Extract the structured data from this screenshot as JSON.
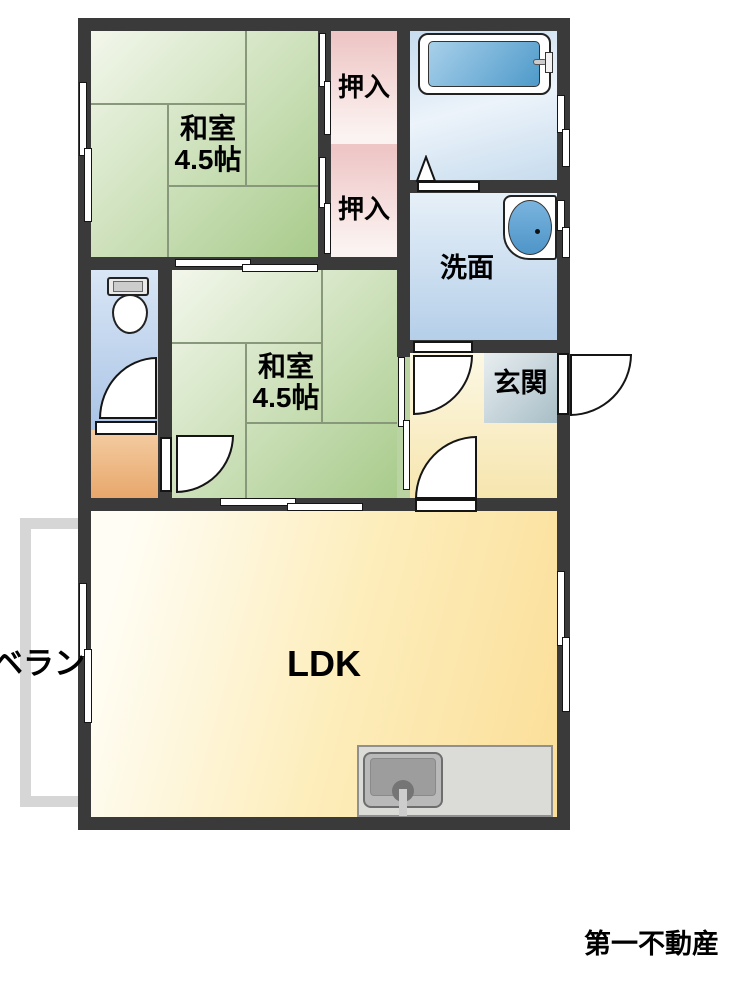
{
  "colors": {
    "wall": "#3a3a3a",
    "tatami-light": "#f3f7ec",
    "tatami-dark": "#a8cb8b",
    "tatami-line": "#87997a",
    "closet-pink": "#eec6c6",
    "closet-pink-pale": "#fbf3f1",
    "bath-blue": "#c7dcee",
    "bath-blue-pale": "#ecf3fa",
    "washroom-blue-top": "#e6f0f8",
    "washroom-blue-bottom": "#b5cfe9",
    "toilet-blue-top": "#d9e6f5",
    "toilet-blue-bottom": "#aac4e6",
    "hall-cream-top": "#fcf8e4",
    "hall-cream-bottom": "#f6e5ae",
    "tile-gray": "#a8bec7",
    "ldk-light": "#fffdf4",
    "ldk-deep": "#fbde98",
    "nook-top": "#f4cda2",
    "nook-bottom": "#e8a76c",
    "balcony": "#d6d6d6",
    "counter": "#dbdbd8",
    "tub-blue": "#4e9aca",
    "tub-blue-light": "#a8d0ea",
    "basin-blue": "#4e95c8"
  },
  "rooms": {
    "washitsu_top": {
      "name": "和室",
      "size": "4.5帖"
    },
    "washitsu_mid": {
      "name": "和室",
      "size": "4.5帖"
    },
    "closet_top": {
      "label": "押入"
    },
    "closet_bottom": {
      "label": "押入"
    },
    "washroom": {
      "label": "洗面"
    },
    "entrance": {
      "label": "玄関"
    },
    "ldk": {
      "label": "LDK"
    },
    "veranda": {
      "label": "ベラン"
    }
  },
  "footer": {
    "company": "第一不動産"
  }
}
